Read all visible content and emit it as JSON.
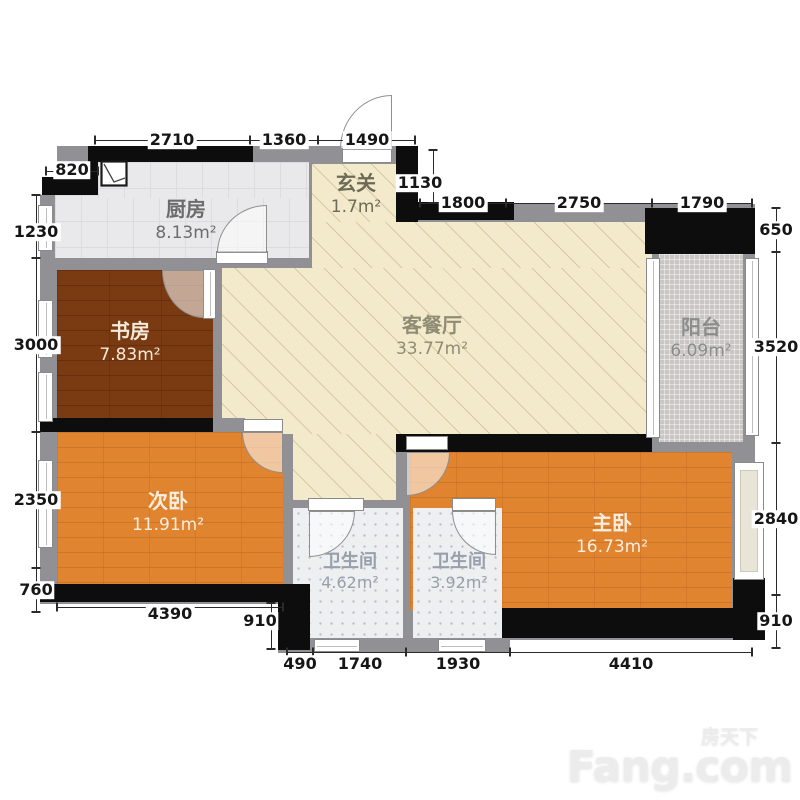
{
  "rooms": [
    {
      "id": "kitchen",
      "name": "厨房",
      "area": "8.13m²"
    },
    {
      "id": "entry",
      "name": "玄关",
      "area": "1.7m²"
    },
    {
      "id": "living",
      "name": "客餐厅",
      "area": "33.77m²"
    },
    {
      "id": "study",
      "name": "书房",
      "area": "7.83m²"
    },
    {
      "id": "balcony",
      "name": "阳台",
      "area": "6.09m²"
    },
    {
      "id": "bedroom2",
      "name": "次卧",
      "area": "11.91m²"
    },
    {
      "id": "master",
      "name": "主卧",
      "area": "16.73m²"
    },
    {
      "id": "bath1",
      "name": "卫生间",
      "area": "4.62m²"
    },
    {
      "id": "bath2",
      "name": "卫生间",
      "area": "3.92m²"
    }
  ],
  "dimensions": {
    "top_outer": [
      "820",
      "2710",
      "1360",
      "1490"
    ],
    "top_inner": [
      "1130",
      "1800",
      "2750",
      "1790"
    ],
    "left": [
      "1230",
      "3000",
      "2350",
      "760"
    ],
    "right": [
      "650",
      "3520",
      "2840",
      "910"
    ],
    "bottom_inner": [
      "4390",
      "910"
    ],
    "bottom_outer": [
      "490",
      "1740",
      "1930",
      "4410"
    ]
  },
  "watermark": {
    "cn": "房天下",
    "en": "Fang.com"
  },
  "colors": {
    "wall_black": "#0d0d0d",
    "wall_gray": "#919095",
    "living_beige": "#f3eacb",
    "kitchen_tile": "#e9e9eb",
    "study_wood": "#7a3a12",
    "bedroom_wood": "#e0842f",
    "balcony_tile": "#c9c6c4",
    "bath_tile": "#edeff1"
  }
}
